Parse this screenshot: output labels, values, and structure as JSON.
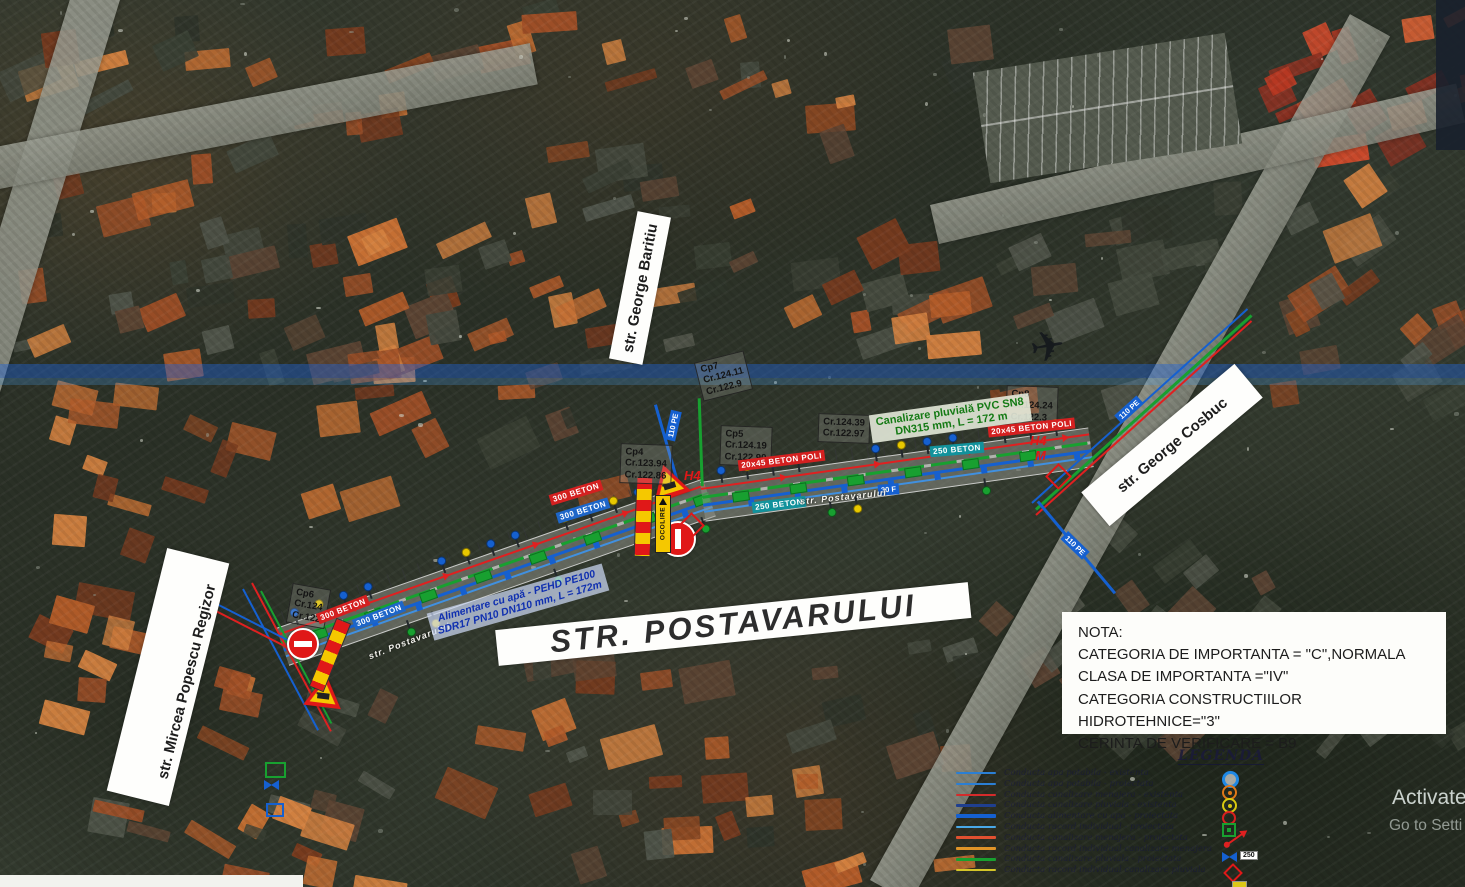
{
  "plan": {
    "street_labels": {
      "baritiu": "str. George Baritiu",
      "cosbuc": "str. George Cosbuc",
      "mircea": "str. Mircea Popescu Regizor",
      "postavarului": "STR. POSTAVARULUI"
    },
    "road_names": [
      "str. Postavarului",
      "str. Postavarului"
    ],
    "annotations": {
      "water": [
        "Alimentare cu apă - PEHD PE100",
        "SDR17 PN10 DN110 mm, L = 172m"
      ],
      "storm": [
        "Canalizare pluvială PVC SN8",
        "DN315 mm, L = 172 m"
      ]
    },
    "nota": {
      "title": "NOTA:",
      "lines": [
        "CATEGORIA DE IMPORTANTA = \"C\",NORMALA",
        "CLASA DE IMPORTANTA =\"IV\"",
        "CATEGORIA CONSTRUCTIILOR HIDROTEHNICE=\"3\"",
        "CERINTA DE VERIFICARE = B9"
      ]
    },
    "chambers": [
      {
        "lines": [
          "Cp6",
          "Cr.124",
          "Cr.122"
        ]
      },
      {
        "lines": [
          "Cp4",
          "Cr.123.94",
          "Cr.122.86"
        ]
      },
      {
        "lines": [
          "Cp7",
          "Cr.124.11",
          "Cr.122.9"
        ]
      },
      {
        "lines": [
          "Cp5",
          "Cr.124.19",
          "Cr.122.90"
        ]
      },
      {
        "lines": [
          "Cr.124.39",
          "Cr.122.97"
        ]
      },
      {
        "lines": [
          "Cp8",
          "Cr.124.24",
          "Cr.122.3"
        ]
      }
    ],
    "beton_labels": [
      "300 BETON",
      "300 BETON",
      "300 BETON",
      "300 BETON",
      "20x45 BETON POLI",
      "250 BETON",
      "250 BETON",
      "20x45 BETON POLI"
    ],
    "pipe_labels": [
      "110 PE",
      "110 PE",
      "110 PE",
      "30 F",
      "H4",
      "H4",
      "M"
    ],
    "signs": {
      "ocolire": "OCOLIRE",
      "valve_size": "250"
    },
    "legend": {
      "title": "LEGENDA",
      "entries": [
        {
          "color": "#2b7fd4",
          "weight": 2,
          "label": "Conducta apa potabila - existenta"
        },
        {
          "color": "#2b7fd4",
          "weight": 2,
          "label": "Conducta apa potabila - proiectata"
        },
        {
          "color": "#d42b2b",
          "weight": 2,
          "label": "Conducta canalizare menajera - existenta"
        },
        {
          "color": "#1f3f8f",
          "weight": 3,
          "label": "Conducta canalizare pluviala - existenta"
        },
        {
          "color": "#1560d0",
          "weight": 4,
          "label": "Conducta alimentare cu apa - proiectata"
        },
        {
          "color": "#49a8e8",
          "weight": 2,
          "label": "Conducta racord individual - proiectata"
        },
        {
          "color": "#e05030",
          "weight": 3,
          "label": "Conducta canalizare menajera - proiectata"
        },
        {
          "color": "#e09428",
          "weight": 2.5,
          "label": "Conducta racord individual canalizare menajera"
        },
        {
          "color": "#18a030",
          "weight": 3,
          "label": "Conducta canalizare pluviala - proiectata"
        },
        {
          "color": "#d4c528",
          "weight": 2.5,
          "label": "Conducta racord individual canalizare pluviala"
        }
      ],
      "symbols": [
        "camin-blue-ring",
        "camin-orange",
        "camin-yellow",
        "camin-red",
        "camin-green-square",
        "hidrant-arrow",
        "vana-250",
        "camin-red-diamond",
        "cutie-yellow"
      ]
    },
    "colors": {
      "water_pipe": "#1560d0",
      "storm_pipe": "#18a030",
      "sewer_existing": "#e02020",
      "barrier_red": "#e01818",
      "barrier_yellow": "#f5c800",
      "beton_red": "#d42020",
      "beton_blue": "#1e66c8",
      "beton_teal": "#12929c"
    }
  },
  "os": {
    "watermark_line1": "Activate",
    "watermark_line2": "Go to Setti"
  }
}
